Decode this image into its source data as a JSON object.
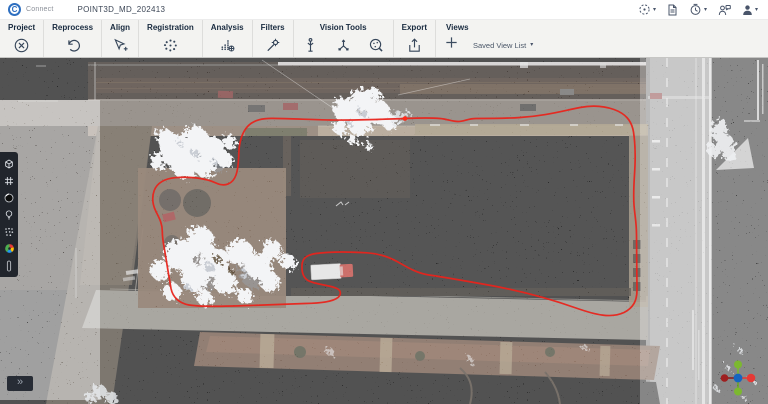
{
  "header": {
    "logo_letter": "C",
    "app_name": "Connect",
    "project_title": "POINT3D_MD_202413",
    "right_icons": [
      "target-mode-icon",
      "document-icon",
      "history-icon",
      "feedback-icon",
      "user-icon"
    ]
  },
  "ribbon": {
    "groups": [
      {
        "label": "Project",
        "icons": [
          "close-project-icon"
        ]
      },
      {
        "label": "Reprocess",
        "icons": [
          "reprocess-icon"
        ]
      },
      {
        "label": "Align",
        "icons": [
          "align-icon"
        ]
      },
      {
        "label": "Registration",
        "icons": [
          "registration-icon"
        ]
      },
      {
        "label": "Analysis",
        "icons": [
          "analysis-icon"
        ]
      },
      {
        "label": "Filters",
        "icons": [
          "filters-icon"
        ]
      },
      {
        "label": "Vision Tools",
        "icons": [
          "scan-station-icon",
          "axes-icon",
          "classification-icon"
        ]
      },
      {
        "label": "Export",
        "icons": [
          "export-icon"
        ]
      },
      {
        "label": "Views",
        "icons": [
          "add-view-icon"
        ],
        "dropdown_label": "Saved View List"
      }
    ]
  },
  "left_toolbar": {
    "icons": [
      "cube-icon",
      "grid-icon",
      "background-toggle-icon",
      "lighting-icon",
      "point-density-icon",
      "color-wheel-icon",
      "slider-icon"
    ],
    "expand_label": "»"
  },
  "viewport": {
    "trajectory_color": "#e8241c",
    "background_color": "#000000",
    "gizmo_colors": {
      "up": "#7cb82f",
      "down": "#7cb82f",
      "left": "#9e1f1f",
      "right": "#e53935",
      "center": "#1565c0"
    }
  }
}
